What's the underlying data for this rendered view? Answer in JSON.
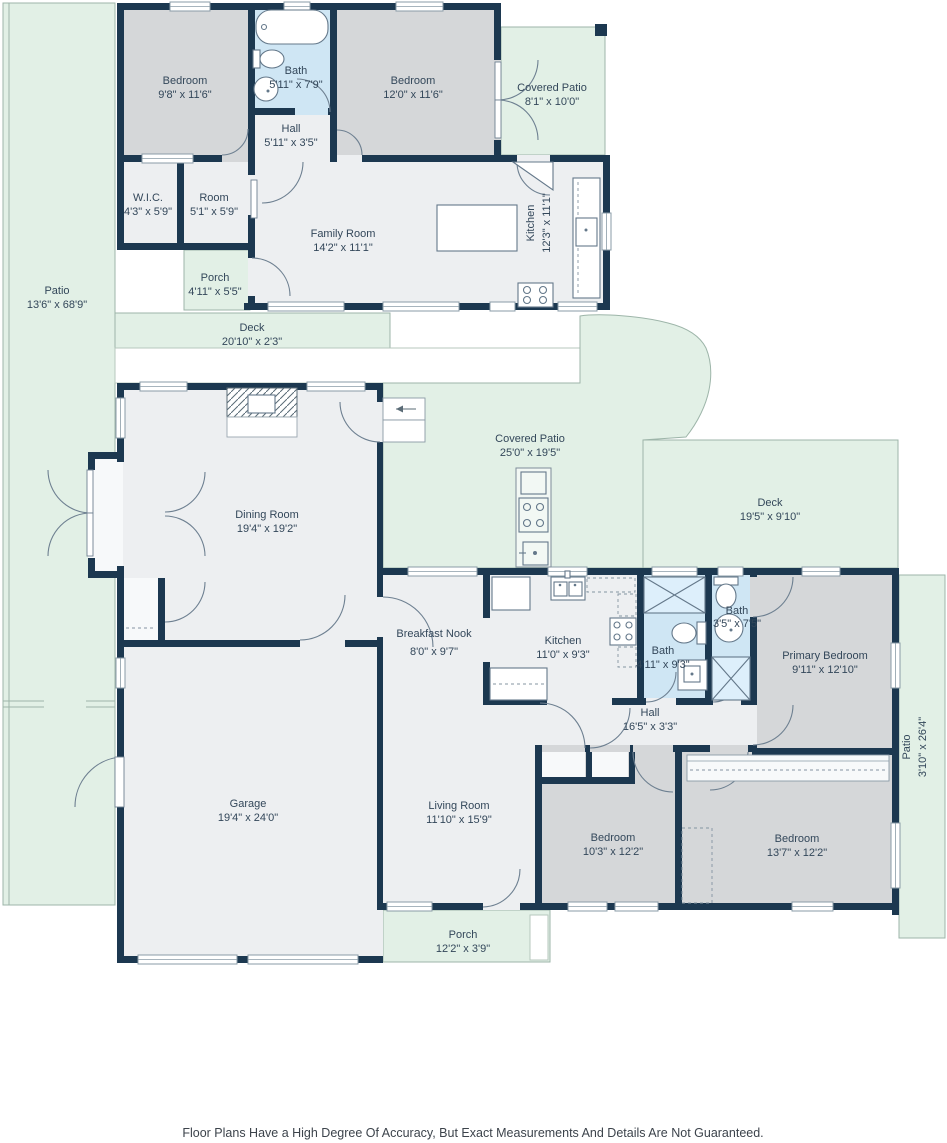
{
  "palette": {
    "wall": "#1c3850",
    "room_grey": "#d5d7d9",
    "room_light": "#edeff1",
    "bath_blue": "#cfe6f4",
    "outdoor_green": "#e2f0e6",
    "outdoor_outline": "#9db5a9",
    "label_text": "#33475a"
  },
  "areas": {
    "upper_bedroom_left": {
      "name": "Bedroom",
      "dims": "9'8\" x 11'6\""
    },
    "upper_bath": {
      "name": "Bath",
      "dims": "5'11\" x 7'9\""
    },
    "upper_bedroom_right": {
      "name": "Bedroom",
      "dims": "12'0\" x 11'6\""
    },
    "upper_covered_patio": {
      "name": "Covered Patio",
      "dims": "8'1\" x 10'0\""
    },
    "upper_hall": {
      "name": "Hall",
      "dims": "5'11\" x 3'5\""
    },
    "wic": {
      "name": "W.I.C.",
      "dims": "4'3\" x 5'9\""
    },
    "room": {
      "name": "Room",
      "dims": "5'1\" x 5'9\""
    },
    "family_room": {
      "name": "Family Room",
      "dims": "14'2\" x 11'1\""
    },
    "upper_kitchen": {
      "name": "Kitchen",
      "dims": "12'3\" x 11'1\""
    },
    "upper_porch": {
      "name": "Porch",
      "dims": "4'11\" x 5'5\""
    },
    "side_patio": {
      "name": "Patio",
      "dims": "13'6\" x 68'9\""
    },
    "upper_deck": {
      "name": "Deck",
      "dims": "20'10\" x 2'3\""
    },
    "dining_room": {
      "name": "Dining Room",
      "dims": "19'4\" x 19'2\""
    },
    "main_covered_patio": {
      "name": "Covered Patio",
      "dims": "25'0\" x 19'5\""
    },
    "main_deck": {
      "name": "Deck",
      "dims": "19'5\" x 9'10\""
    },
    "breakfast_nook": {
      "name": "Breakfast Nook",
      "dims": "8'0\" x 9'7\""
    },
    "main_kitchen": {
      "name": "Kitchen",
      "dims": "11'0\" x 9'3\""
    },
    "main_bath": {
      "name": "Bath",
      "dims": "4'11\" x 9'3\""
    },
    "small_bath": {
      "name": "Bath",
      "dims": "3'5\" x 7'5\""
    },
    "primary_bedroom": {
      "name": "Primary Bedroom",
      "dims": "9'11\" x 12'10\""
    },
    "main_hall": {
      "name": "Hall",
      "dims": "16'5\" x 3'3\""
    },
    "garage": {
      "name": "Garage",
      "dims": "19'4\" x 24'0\""
    },
    "living_room": {
      "name": "Living Room",
      "dims": "11'10\" x 15'9\""
    },
    "bedroom_small": {
      "name": "Bedroom",
      "dims": "10'3\" x 12'2\""
    },
    "bedroom_large": {
      "name": "Bedroom",
      "dims": "13'7\" x 12'2\""
    },
    "rear_patio": {
      "name": "Patio",
      "dims": "3'10\" x 26'4\""
    },
    "main_porch": {
      "name": "Porch",
      "dims": "12'2\" x 3'9\""
    }
  },
  "footer": {
    "disclaimer": "Floor Plans Have a High Degree Of Accuracy, But Exact Measurements And Details Are Not Guaranteed."
  }
}
